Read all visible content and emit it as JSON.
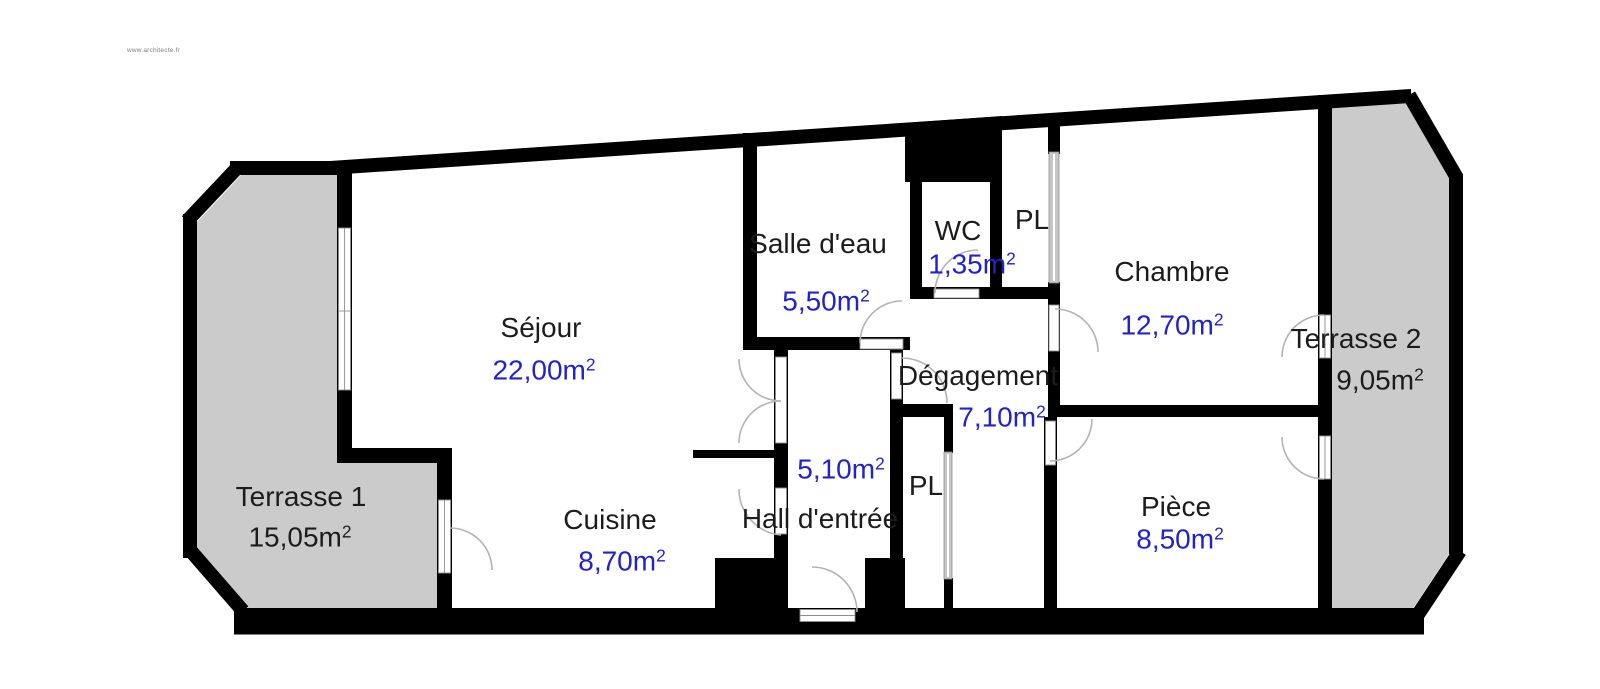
{
  "watermark": "www.architecte.fr",
  "units": {
    "unit": "m",
    "sup": "2"
  },
  "rooms": {
    "sejour": {
      "name": "Séjour",
      "area": "22,00"
    },
    "cuisine": {
      "name": "Cuisine",
      "area": "8,70"
    },
    "salle_eau": {
      "name": "Salle d'eau",
      "area": "5,50"
    },
    "wc": {
      "name": "WC",
      "area": "1,35"
    },
    "pl_haut": {
      "name": "PL"
    },
    "chambre": {
      "name": "Chambre",
      "area": "12,70"
    },
    "degagement": {
      "name": "Dégagement",
      "area": "7,10"
    },
    "hall": {
      "name": "Hall d'entrée",
      "area": "5,10"
    },
    "pl_bas": {
      "name": "PL"
    },
    "piece": {
      "name": "Pièce",
      "area": "8,50"
    },
    "terrasse1": {
      "name": "Terrasse 1",
      "area": "15,05"
    },
    "terrasse2": {
      "name": "Terrasse 2",
      "area": "9,05"
    }
  },
  "colors": {
    "wall": "#000000",
    "terrace_fill": "#cbcbcb",
    "room_name_text": "#1c1c1c",
    "room_area_text": "#2121cd",
    "door_arc": "#b3b3b3",
    "window_frame": "#8f8f8f"
  }
}
